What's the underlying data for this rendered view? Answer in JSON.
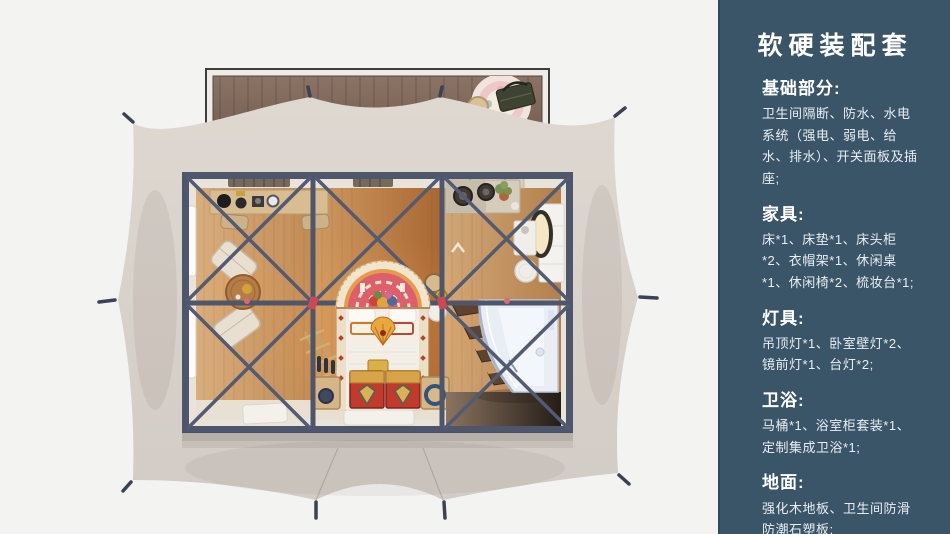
{
  "sidebar": {
    "bg_color": "#3a5568",
    "text_color": "#ffffff",
    "title": "软硬装配套",
    "sections": [
      {
        "heading": "基础部分:",
        "body": "卫生间隔断、防水、水电系统（强电、弱电、给水、排水）、开关面板及插座;"
      },
      {
        "heading": "家具:",
        "body": "床*1、床垫*1、床头柜*2、衣帽架*1、休闲桌*1、休闲椅*2、梳妆台*1;"
      },
      {
        "heading": "灯具:",
        "body": "吊顶灯*1、卧室壁灯*2、镜前灯*1、台灯*2;"
      },
      {
        "heading": "卫浴:",
        "body": "马桶*1、浴室柜套装*1、定制集成卫浴*1;"
      },
      {
        "heading": "地面:",
        "body": "强化木地板、卫生间防滑防潮石塑板;"
      }
    ]
  },
  "scene": {
    "background": "#f3f3f2",
    "tent_fabric": "#d8d1ca",
    "steel_frame": "#4d566b",
    "joint_tie_red": "#cf4753",
    "deck_wood": "#7d6758",
    "floor_wood": "#c08a52",
    "bed_linen": "#f4efe6",
    "headboard_rug_pink": "#dd5f6b",
    "trunk_red": "#c23a2b",
    "bathroom_glass": "#e9edf4"
  }
}
